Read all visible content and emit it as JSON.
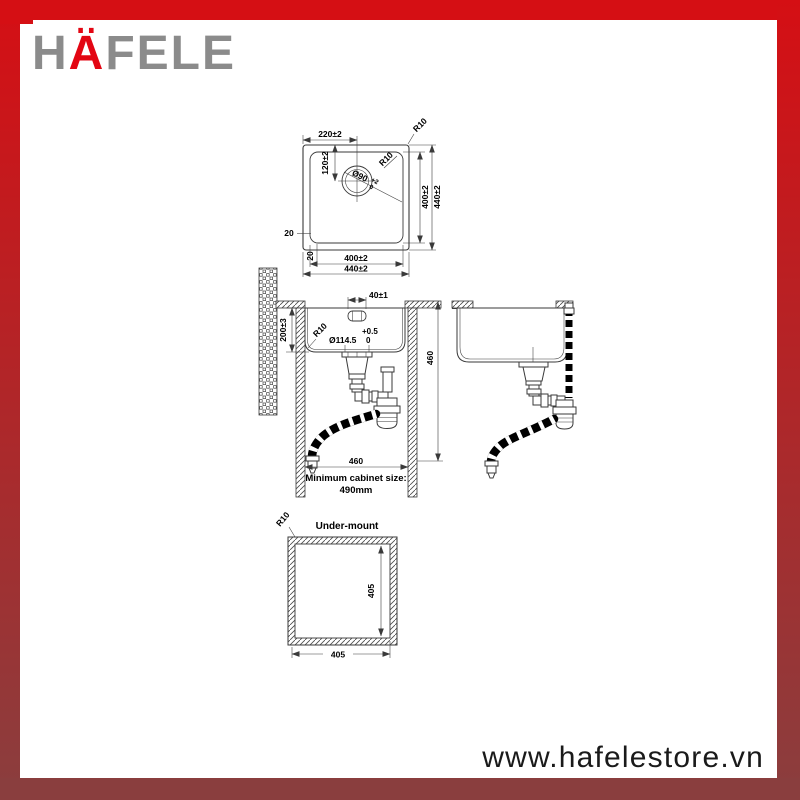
{
  "colors": {
    "brand_red": "#d50f14",
    "maroon": "#8a3e3e",
    "logo_gray": "#8b8b8b",
    "logo_red": "#e30613",
    "line": "#3a3a3a"
  },
  "logo": {
    "h": "H",
    "a_umlaut": "Ä",
    "rest": "FELE"
  },
  "footer": {
    "website": "www.hafelestore.vn"
  },
  "top_view": {
    "dim_width_to_drain": "220±2",
    "radius_outer": "R10",
    "radius_inner": "R10",
    "dim_drain_from_top": "120±2",
    "drain_diameter": "Ø90",
    "drain_tol_upper": "+2",
    "drain_tol_lower": "0",
    "dim_inner_height": "400±2",
    "dim_outer_height": "440±2",
    "rim_left": "20",
    "rim_bottom": "20",
    "dim_inner_width": "400±2",
    "dim_outer_width": "440±2"
  },
  "section_view": {
    "dim_overflow": "40±1",
    "dim_depth": "200±3",
    "radius_bottom": "R10",
    "waste_tol_upper": "+0.5",
    "waste_diameter": "Ø114.5",
    "waste_tol_lower": "0",
    "dim_height": "460",
    "dim_cabinet_width": "460",
    "cabinet_note_line1": "Minimum cabinet size:",
    "cabinet_note_line2": "490mm"
  },
  "under_mount": {
    "radius": "R10",
    "title": "Under-mount",
    "dim_height": "405",
    "dim_width": "405"
  }
}
